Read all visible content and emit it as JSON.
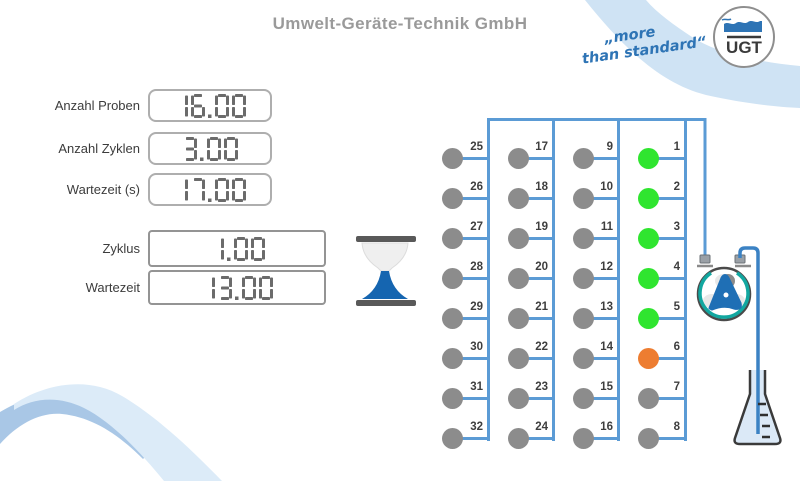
{
  "header": {
    "title": "Umwelt-Geräte-Technik GmbH",
    "tagline": [
      "„more",
      "than standard“"
    ],
    "logo_text": "UGT"
  },
  "settings_fields": [
    {
      "label": "Anzahl Proben",
      "value": "16.00"
    },
    {
      "label": "Anzahl Zyklen",
      "value": "3.00"
    },
    {
      "label": "Wartezeit (s)",
      "value": "17.00"
    }
  ],
  "status_fields": [
    {
      "label": "Zyklus",
      "value": "1.00"
    },
    {
      "label": "Wartezeit",
      "value": "13.00"
    }
  ],
  "ports": {
    "columns": [
      [
        25,
        26,
        27,
        28,
        29,
        30,
        31,
        32
      ],
      [
        17,
        18,
        19,
        20,
        21,
        22,
        23,
        24
      ],
      [
        9,
        10,
        11,
        12,
        13,
        14,
        15,
        16
      ],
      [
        1,
        2,
        3,
        4,
        5,
        6,
        7,
        8
      ]
    ],
    "states": {
      "1": "green",
      "2": "green",
      "3": "green",
      "4": "green",
      "5": "green",
      "6": "orange"
    },
    "default_state": "gray"
  },
  "colors": {
    "green": "#2fe52f",
    "orange": "#ed7d31",
    "gray": "#8c8c8c",
    "pipe": "#5b9bd5",
    "tube": "#3b82c4",
    "accent_blue": "#2e74b5",
    "segment": "#6b6b6b"
  },
  "icons": {
    "hourglass-icon": "hourglass with blue sand in lower bulb",
    "peristaltic-pump-icon": "circular pump with blue rotor and teal tube",
    "erlenmeyer-flask-icon": "conical flask with graduations, filled light blue",
    "ugt-logo": "circle with water wave and UGT letters"
  }
}
